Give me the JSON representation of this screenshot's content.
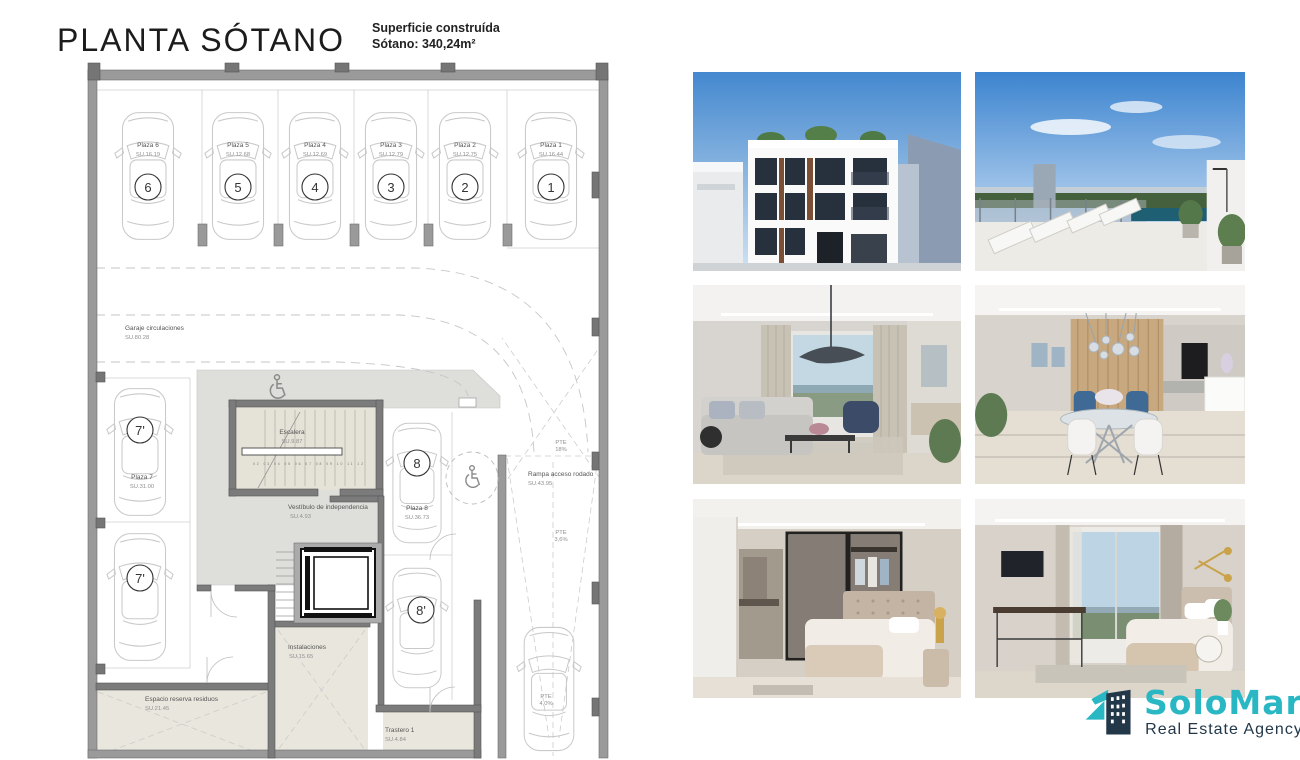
{
  "header": {
    "title": "PLANTA SÓTANO",
    "surface_line1": "Superficie construída",
    "surface_line2": "Sótano: 340,24m²"
  },
  "plan": {
    "parking_spots": [
      {
        "label": "Plaza 6",
        "su": "SU.16.19",
        "num": "6"
      },
      {
        "label": "Plaza 5",
        "su": "SU.12.68",
        "num": "5"
      },
      {
        "label": "Plaza 4",
        "su": "SU.12.69",
        "num": "4"
      },
      {
        "label": "Plaza 3",
        "su": "SU.12.79",
        "num": "3"
      },
      {
        "label": "Plaza 2",
        "su": "SU.12.75",
        "num": "2"
      },
      {
        "label": "Plaza 1",
        "su": "SU.16.44",
        "num": "1"
      }
    ],
    "garage": {
      "label": "Garaje circulaciones",
      "su": "SU.80.28"
    },
    "plaza7": {
      "label": "Plaza 7",
      "su": "SU.31.00",
      "num": "7'"
    },
    "plaza8": {
      "label": "Plaza 8",
      "su": "SU.36.73",
      "num": "8",
      "num_storage": "8'"
    },
    "escalera": {
      "label": "Escalera",
      "su": "SU.9.87",
      "steps": "02 03 04 05 06 07 08 09 10 11 12"
    },
    "vestibulo": {
      "label": "Vestíbulo de independencia",
      "su": "SU.4.93"
    },
    "rampa": {
      "label": "Rampa acceso rodado",
      "su": "SU.43.95",
      "slope_top": {
        "l1": "PTE",
        "l2": "18%"
      },
      "slope_mid": {
        "l1": "PTE",
        "l2": "3,6%"
      },
      "slope_bottom": {
        "l1": "PTE",
        "l2": "4,0%"
      }
    },
    "residuos": {
      "label": "Espacio reserva residuos",
      "su": "SU.21.45"
    },
    "instalaciones": {
      "label": "Instalaciones",
      "su": "SU.15.65"
    },
    "trastero": {
      "label": "Trastero 1",
      "su": "SU.4.84"
    }
  },
  "photos": [
    {
      "name": "building-facade"
    },
    {
      "name": "rooftop-terrace-pool"
    },
    {
      "name": "living-room"
    },
    {
      "name": "dining-kitchen"
    },
    {
      "name": "bedroom-walkin-closet"
    },
    {
      "name": "bedroom-sea-view"
    }
  ],
  "logo": {
    "brand": "SoloMar",
    "tagline": "Real Estate Agency",
    "accent_color": "#29b7c4",
    "navy_color": "#223849"
  }
}
